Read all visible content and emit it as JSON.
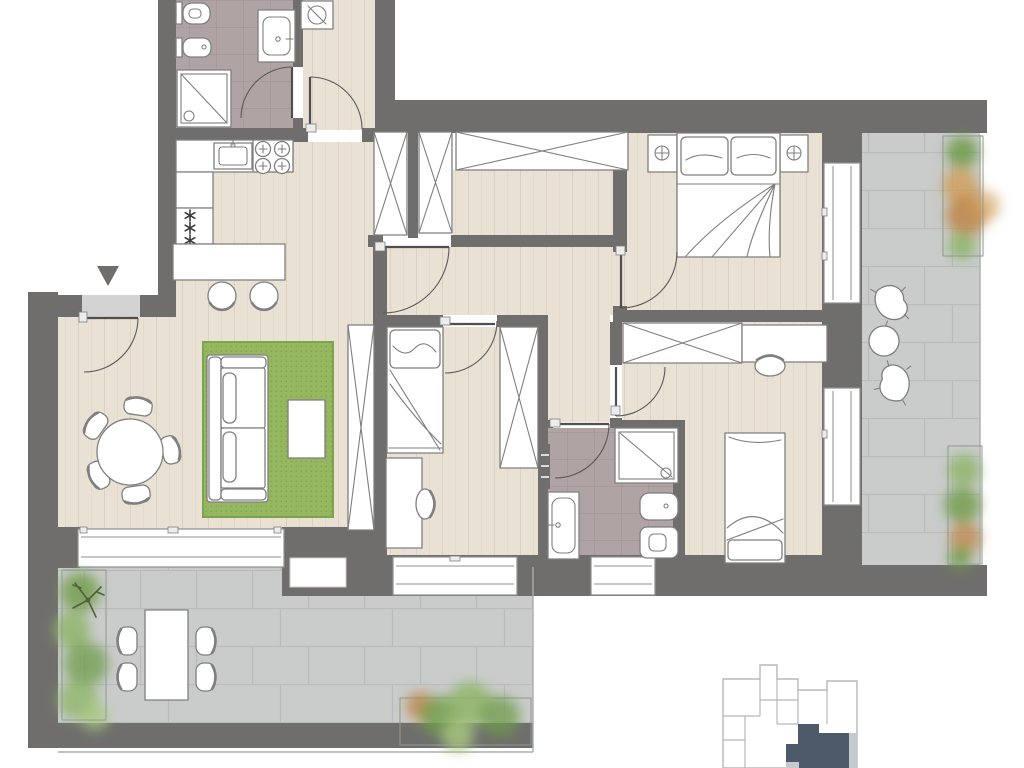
{
  "scene": {
    "type": "apartment-floor-plan",
    "rooms": [
      {
        "name": "bathroom-1",
        "fixtures": [
          "wall-hung-toilet",
          "bidet",
          "shower",
          "vanity-sink",
          "door"
        ]
      },
      {
        "name": "laundry-hall",
        "fixtures": [
          "washing-machine",
          "door"
        ]
      },
      {
        "name": "kitchen",
        "fixtures": [
          "kitchen-sink",
          "hob-4-burners",
          "radiator",
          "peninsula-counter",
          "bar-stool",
          "bar-stool"
        ]
      },
      {
        "name": "living-dining",
        "fixtures": [
          "entrance-door",
          "doormat",
          "entrance-marker",
          "round-dining-table",
          "dining-chair-x5",
          "sofa",
          "coffee-table",
          "rug",
          "tall-wardrobe"
        ]
      },
      {
        "name": "hallway",
        "fixtures": [
          "closet",
          "closet",
          "wide-wardrobe",
          "hall-door"
        ]
      },
      {
        "name": "bedroom-master",
        "fixtures": [
          "double-bed",
          "nightstand",
          "nightstand",
          "lamp",
          "lamp",
          "window",
          "door"
        ]
      },
      {
        "name": "bedroom-1",
        "fixtures": [
          "single-bed",
          "desk",
          "chair",
          "wardrobe",
          "window",
          "door"
        ]
      },
      {
        "name": "bedroom-2",
        "fixtures": [
          "single-bed",
          "desk",
          "chair",
          "wardrobe",
          "window",
          "door"
        ]
      },
      {
        "name": "bathroom-2",
        "fixtures": [
          "shower",
          "vanity-sink",
          "bidet",
          "toilet",
          "towel-radiator",
          "window",
          "door"
        ]
      },
      {
        "name": "terrace-side",
        "fixtures": [
          "lounge-chair",
          "lounge-chair",
          "side-table",
          "planter",
          "planter",
          "stone-paving"
        ]
      },
      {
        "name": "terrace-main",
        "fixtures": [
          "outdoor-table",
          "outdoor-chair-x4",
          "planter-with-tree",
          "shrub-planter",
          "stone-paving"
        ]
      }
    ],
    "keyplan": {
      "highlighted_unit": true
    }
  },
  "colors": {
    "background": "#ffffff",
    "wall": "#6f6e6c",
    "wood": "#eae1d5",
    "wood_line": "#ddd0c0",
    "tile": "#afa3a3",
    "tile_line": "#a09292",
    "stone": "#c9cccb",
    "stone_line": "#b8bcbb",
    "rug": "#94b75f",
    "rug_dot": "#7fa34c",
    "doormat": "#d3d3d3",
    "fixture_stroke": "#7f7f7f",
    "door_arc": "#5a5a5a",
    "window_frame": "#8f8f8f",
    "thin_edge": "#a9adac",
    "keyplan_outline": "#b5b8bc",
    "keyplan_unit": "#4d5a6a",
    "keyplan_accent": "#c6cad0",
    "plant_dark": "#6f9c49",
    "plant_mid": "#8fb56a",
    "plant_light": "#a9c981",
    "plant_orange": "#bd8040",
    "plant_amber": "#cf9d55",
    "branch": "#53603f",
    "planter_edge": "#8f9a8f"
  }
}
